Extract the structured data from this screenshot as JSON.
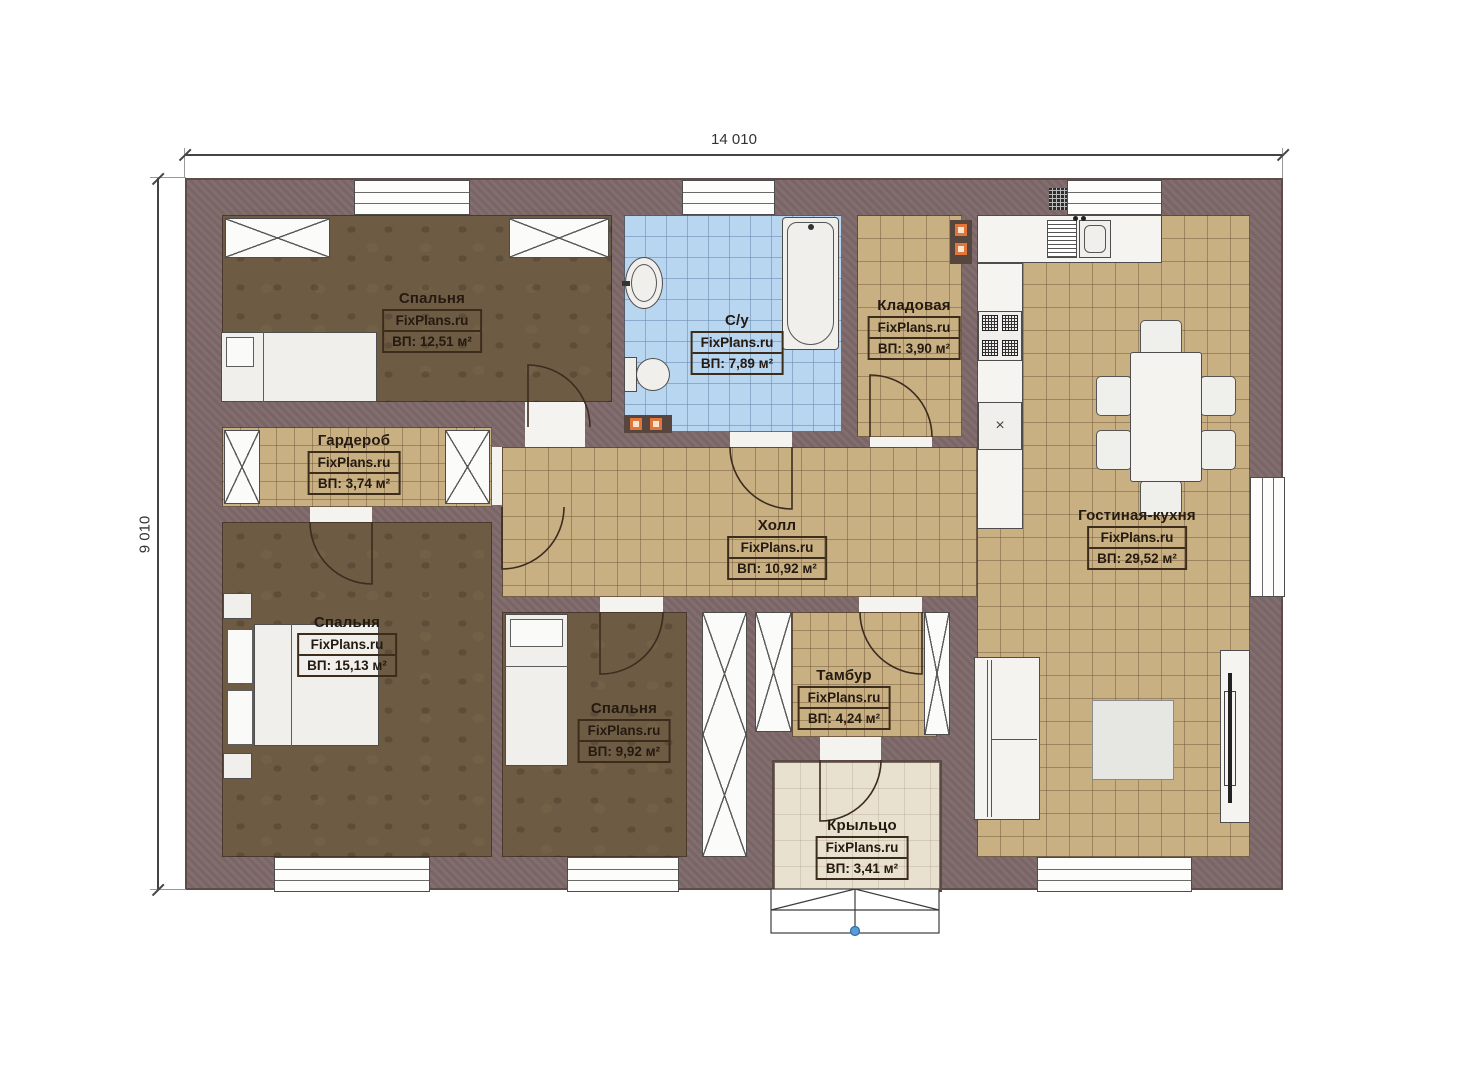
{
  "title": "Одноэтажный план дома",
  "watermark": "FixPlans.ru",
  "dimensions": {
    "width": "14 010",
    "height": "9 010"
  },
  "rooms": [
    {
      "key": "bedroom-1",
      "name": "Спальня",
      "area": "ВП: 12,51 м²"
    },
    {
      "key": "bathroom",
      "name": "С/у",
      "area": "ВП: 7,89 м²"
    },
    {
      "key": "storage",
      "name": "Кладовая",
      "area": "ВП: 3,90 м²"
    },
    {
      "key": "wardrobe",
      "name": "Гардероб",
      "area": "ВП: 3,74 м²"
    },
    {
      "key": "hall",
      "name": "Холл",
      "area": "ВП: 10,92 м²"
    },
    {
      "key": "living-kitchen",
      "name": "Гостиная-кухня",
      "area": "ВП: 29,52 м²"
    },
    {
      "key": "bedroom-2",
      "name": "Спальня",
      "area": "ВП: 15,13 м²"
    },
    {
      "key": "bedroom-3",
      "name": "Спальня",
      "area": "ВП: 9,92 м²"
    },
    {
      "key": "tambour",
      "name": "Тамбур",
      "area": "ВП: 4,24 м²"
    },
    {
      "key": "porch",
      "name": "Крыльцо",
      "area": "ВП: 3,41 м²"
    }
  ],
  "colors": {
    "wall": "#7d6769",
    "floor_dark": "#6d5b44",
    "floor_tile": "#c8b083",
    "bathroom_tile": "#b9d6f0",
    "porch": "#e9e1cf",
    "accent_orange": "#e0763c",
    "step_dot_blue": "#5b9bd5"
  }
}
